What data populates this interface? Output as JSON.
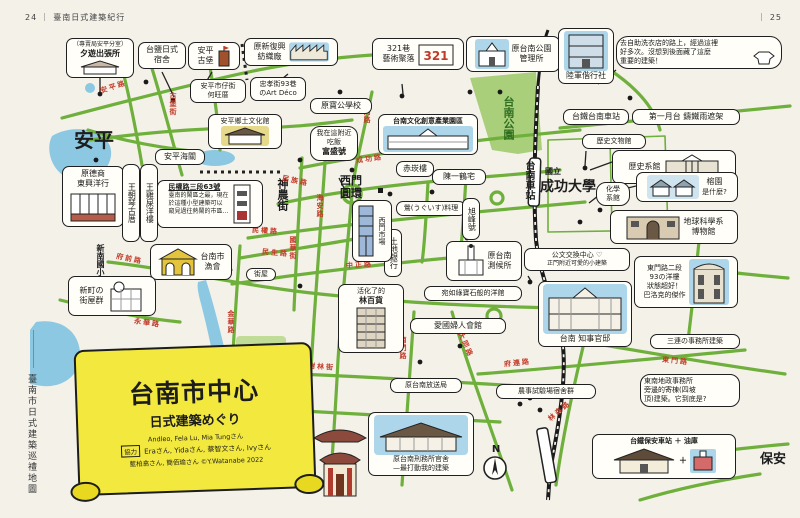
{
  "page": {
    "left_no": "24",
    "left_title": "臺南日式建築紀行",
    "right_no": "25",
    "spine": "臺南市日式建築巡禮地圖",
    "divider": "｜"
  },
  "banner": {
    "title": "台南市中心",
    "subtitle": "日式建築めぐり",
    "names": "Andleo, Fela Lu, Mia Tungさん",
    "coop_label": "協力",
    "coop": "Eraさん, Yidaさん, 蔡智文さん, Ivyさん",
    "credit": "藍柏翕さん, 簡佰瑜さん ©Y.Watanabe 2022"
  },
  "compass": {
    "label": "N"
  },
  "misc": {
    "plus": "＋"
  },
  "areas": {
    "anping": "安平",
    "shennong": "神農街",
    "ximen": "西門圓環",
    "park": "台南公園",
    "station": "台南車站",
    "ncku_pre": "國立",
    "ncku": "成功大學",
    "baoan": "保安",
    "pond": "水萍塭公園",
    "xinnan": "新南國小"
  },
  "roads": [
    "安平路",
    "古堡街",
    "民族路",
    "成功路",
    "西門路",
    "海安路",
    "國華街",
    "民權路",
    "民生路",
    "中正路",
    "金華路",
    "府前路",
    "永華路",
    "南門路",
    "大同路",
    "府連路",
    "東門路",
    "林森路",
    "樹林街"
  ],
  "callouts": [
    {
      "lines": [
        "（專賣局安平分室）",
        "夕遊出張所"
      ]
    },
    {
      "lines": [
        "台鹽日式",
        "宿舍"
      ]
    },
    {
      "lines": [
        "安平",
        "古堡"
      ]
    },
    {
      "lines": [
        "原新復興",
        "紡織廠"
      ]
    },
    {
      "lines": [
        "321巷",
        "藝術聚落"
      ]
    },
    {
      "lines": [
        "原台南公園",
        "管理所"
      ]
    },
    {
      "lines": [
        "陸軍偕行社"
      ]
    },
    {
      "lines": [
        "去自助洗衣店的路上，經過這裡",
        "好多次。沒想到後面藏了這麼",
        "重要的建築！"
      ]
    },
    {
      "lines": [
        "台鐵台南車站"
      ]
    },
    {
      "lines": [
        "第一月台 鑄鐵雨遮架"
      ]
    },
    {
      "lines": [
        "安平市仔街",
        "何旺厝"
      ]
    },
    {
      "lines": [
        "忠孝街93巷",
        "のArt Déco"
      ]
    },
    {
      "lines": [
        "原寶公學校"
      ]
    },
    {
      "lines": [
        "安平鄉土文化館"
      ]
    },
    {
      "lines": [
        "安平海關"
      ]
    },
    {
      "lines": [
        "原德商",
        "東興洋行"
      ]
    },
    {
      "lines": [
        "王雞屎洋樓"
      ]
    },
    {
      "lines": [
        "王朝琴古厝"
      ]
    },
    {
      "lines": [
        "民權路三段63號",
        "臺南的鬧區之最，現在",
        "於這種小型建築可以",
        "窺見過往熱鬧的市區…"
      ]
    },
    {
      "lines": [
        "台南文化創意產業園區"
      ]
    },
    {
      "lines": [
        "我在這附近",
        "吃飯",
        "富盛號"
      ]
    },
    {
      "lines": [
        "赤崁樓"
      ]
    },
    {
      "lines": [
        "陳一鶴宅"
      ]
    },
    {
      "lines": [
        "鶯(うぐいす)料理"
      ]
    },
    {
      "lines": [
        "旭峰號"
      ]
    },
    {
      "lines": [
        "土地銀行"
      ]
    },
    {
      "lines": [
        "西門市場"
      ]
    },
    {
      "lines": [
        "原台南",
        "測候所"
      ]
    },
    {
      "lines": [
        "宛如綠寶石般的洋館"
      ]
    },
    {
      "lines": [
        "歷史文物館"
      ]
    },
    {
      "lines": [
        "歷史系館"
      ]
    },
    {
      "lines": [
        "化學",
        "系館"
      ]
    },
    {
      "lines": [
        "榕園",
        "是什麼?"
      ]
    },
    {
      "lines": [
        "地球科學系",
        "博物館"
      ]
    },
    {
      "lines": [
        "公文交換中心 ♡",
        "正門附近可愛的小建築"
      ]
    },
    {
      "lines": [
        "東門路二段",
        "93の洋樓",
        "狀態超好！",
        "巴洛克的傑作"
      ]
    },
    {
      "lines": [
        "台南 知事官邸"
      ]
    },
    {
      "lines": [
        "三連の事務所建築"
      ]
    },
    {
      "lines": [
        "東南地政事務所",
        "旁邊的寄棟(四坡",
        "頂)建築。它到底是?"
      ]
    },
    {
      "lines": [
        "農事試驗場宿舍群"
      ]
    },
    {
      "lines": [
        "台鐵保安車站 ＋ 油庫"
      ]
    },
    {
      "lines": [
        "原台南刑務所官舍",
        "—最打動我的建築"
      ]
    },
    {
      "lines": [
        "保安宮",
        "＋",
        "保安路",
        "＋",
        "海安路",
        "理髮店"
      ]
    },
    {
      "lines": [
        "原台南放送局"
      ]
    },
    {
      "lines": [
        "愛國婦人會館"
      ]
    },
    {
      "lines": [
        "活化了的",
        "林百貨"
      ]
    },
    {
      "lines": [
        "台南市",
        "漁會"
      ]
    },
    {
      "lines": [
        "新町の",
        "街屋群"
      ]
    },
    {
      "lines": [
        "街屋"
      ]
    }
  ]
}
